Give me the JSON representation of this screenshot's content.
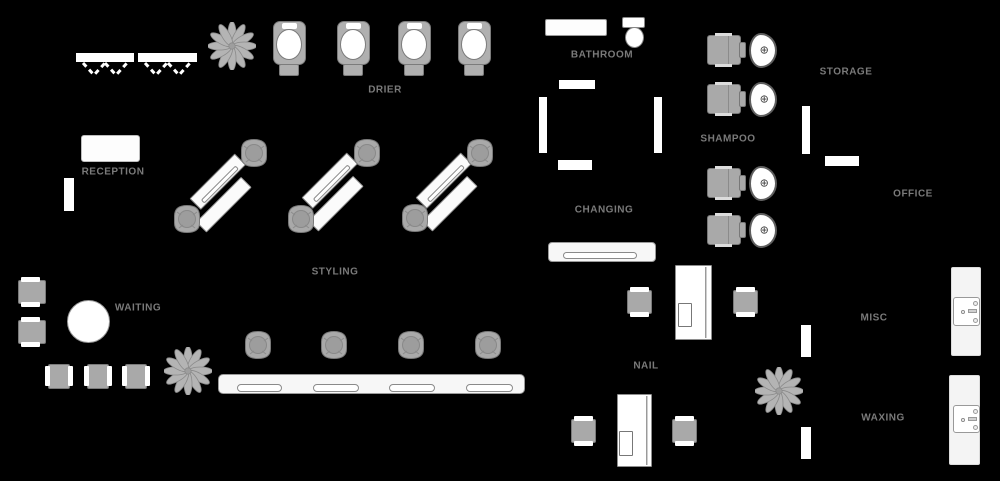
{
  "diagram_type": "salon-floor-plan",
  "colors": {
    "background": "#000000",
    "label_text": "#7a7a7a",
    "wall_fill": "#ffffff",
    "furniture_white": "#ffffff",
    "counter_light": "#f4f4f4",
    "chair_gray": "#a9a9a9",
    "outline_gray": "#7a7a7a",
    "plant_gray": "#b4b4b4"
  },
  "labels": {
    "reception": "RECEPTION",
    "drier": "DRIER",
    "bathroom": "BATHROOM",
    "changing": "CHANGING",
    "shampoo": "SHAMPOO",
    "storage": "STORAGE",
    "office": "OFFICE",
    "styling": "STYLING",
    "waiting": "WAITING",
    "nail": "NAIL",
    "misc": "MISC",
    "waxing": "WAXING"
  },
  "icons": {
    "sink_faucet_glyph": "⊕",
    "plant": "12-petal flower shape",
    "rack_hanger": "dashed chevron"
  },
  "inventory": {
    "drier_chairs": 4,
    "shampoo_stations": 4,
    "styling_stations_diagonal": 3,
    "styling_counter_slots": 4,
    "styling_chairs": 10,
    "waiting_chairs": 5,
    "nail_tables": 2,
    "nail_chairs": 4,
    "plants": 3,
    "sink_counters": 2,
    "toilets": 1
  }
}
